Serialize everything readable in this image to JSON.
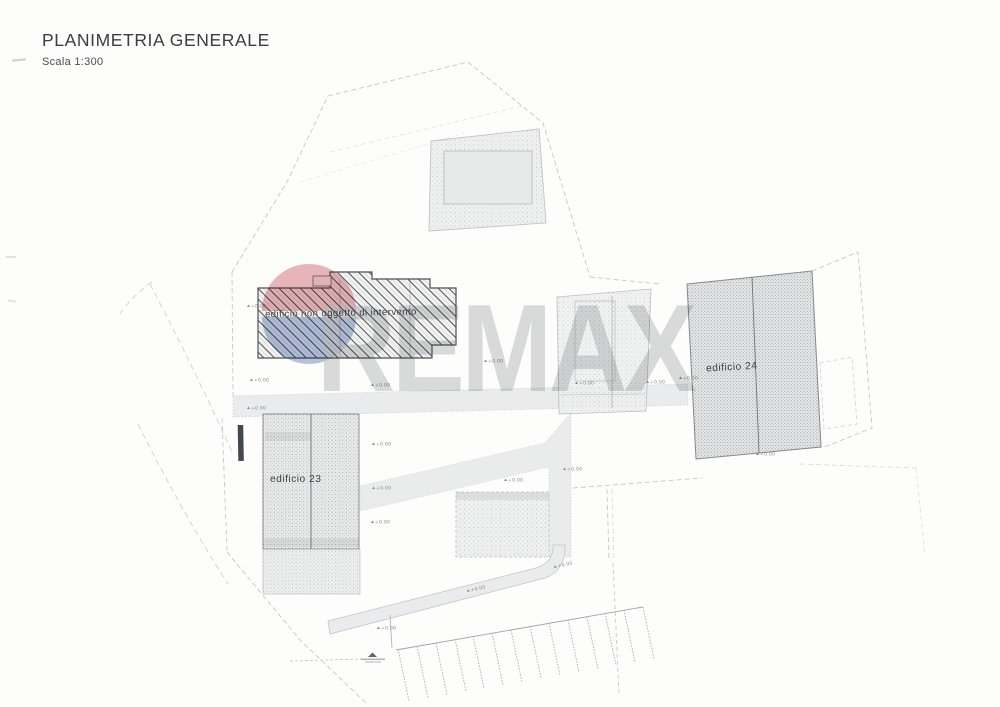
{
  "header": {
    "title": "PLANIMETRIA GENERALE",
    "scale": "Scala 1:300"
  },
  "watermark": {
    "text": "REMAX",
    "text_color": "#c3c6c7",
    "balloon_top_color": "#c9515d",
    "balloon_bottom_color": "#5570b4"
  },
  "plan": {
    "building_existing_label": "edificio non oggetto di intervento",
    "building_23_label": "edificio 23",
    "building_24_label": "edificio 24",
    "elevation_label": "+0.00"
  }
}
